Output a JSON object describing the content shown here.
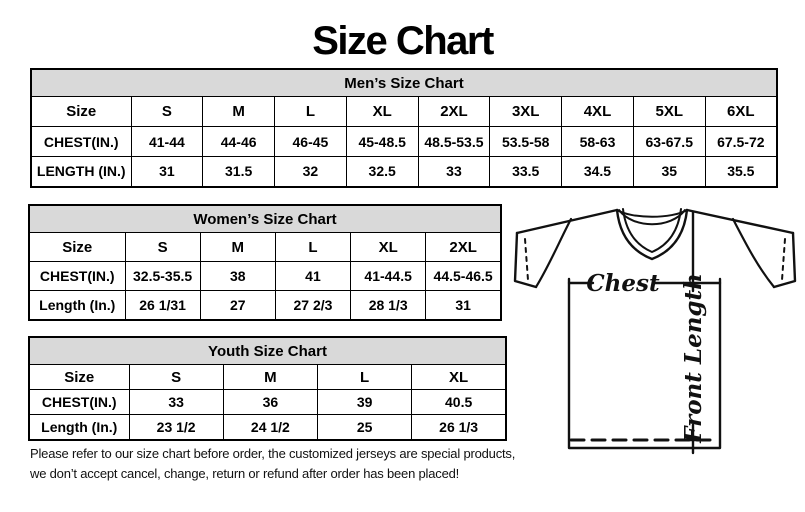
{
  "page": {
    "title": "Size Chart"
  },
  "colors": {
    "background": "#ffffff",
    "table_header_bg": "#d9d9d9",
    "border": "#000000",
    "text": "#000000"
  },
  "tables": [
    {
      "title": "Men’s Size Chart",
      "rows": [
        {
          "header": "Size",
          "values": [
            "S",
            "M",
            "L",
            "XL",
            "2XL",
            "3XL",
            "4XL",
            "5XL",
            "6XL"
          ]
        },
        {
          "header": "CHEST(IN.)",
          "values": [
            "41-44",
            "44-46",
            "46-45",
            "45-48.5",
            "48.5-53.5",
            "53.5-58",
            "58-63",
            "63-67.5",
            "67.5-72"
          ]
        },
        {
          "header": "LENGTH (IN.)",
          "values": [
            "31",
            "31.5",
            "32",
            "32.5",
            "33",
            "33.5",
            "34.5",
            "35",
            "35.5"
          ]
        }
      ]
    },
    {
      "title": "Women’s Size Chart",
      "rows": [
        {
          "header": "Size",
          "values": [
            "S",
            "M",
            "L",
            "XL",
            "2XL"
          ]
        },
        {
          "header": "CHEST(IN.)",
          "values": [
            "32.5-35.5",
            "38",
            "41",
            "41-44.5",
            "44.5-46.5"
          ]
        },
        {
          "header": "Length (In.)",
          "values": [
            "26 1/31",
            "27",
            "27 2/3",
            "28 1/3",
            "31"
          ]
        }
      ]
    },
    {
      "title": "Youth Size Chart",
      "rows": [
        {
          "header": "Size",
          "values": [
            "S",
            "M",
            "L",
            "XL"
          ]
        },
        {
          "header": "CHEST(IN.)",
          "values": [
            "33",
            "36",
            "39",
            "40.5"
          ]
        },
        {
          "header": "Length (In.)",
          "values": [
            "23 1/2",
            "24 1/2",
            "25",
            "26 1/3"
          ]
        }
      ]
    }
  ],
  "diagram": {
    "chest_label": "Chest",
    "front_length_label": "Front Length"
  },
  "footer": {
    "line1": "Please refer to our size chart before order, the customized jerseys are special products,",
    "line2": "we don’t accept cancel, change, return or refund after order has been placed!"
  }
}
